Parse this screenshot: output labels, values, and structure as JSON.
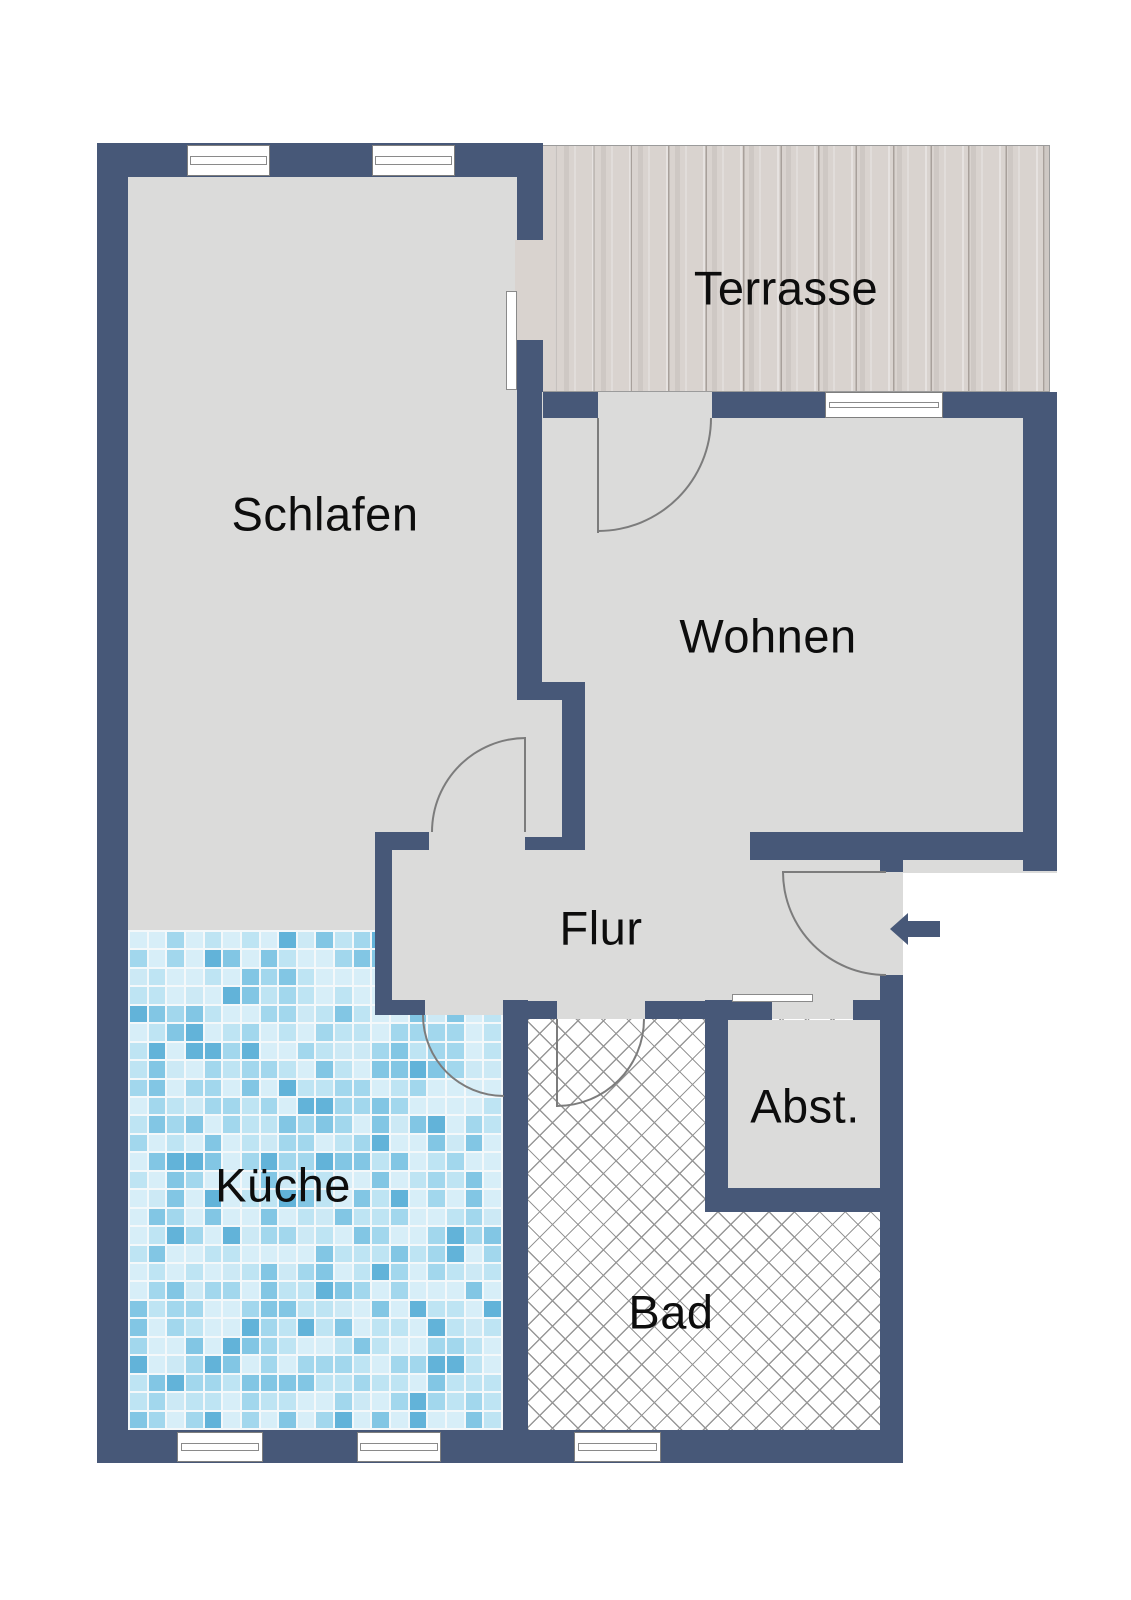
{
  "rooms": [
    {
      "id": "schlafen",
      "label": "Schlafen"
    },
    {
      "id": "terrasse",
      "label": "Terrasse"
    },
    {
      "id": "wohnen",
      "label": "Wohnen"
    },
    {
      "id": "flur",
      "label": "Flur"
    },
    {
      "id": "kueche",
      "label": "Küche"
    },
    {
      "id": "abstellraum",
      "label": "Abst."
    },
    {
      "id": "bad",
      "label": "Bad"
    }
  ],
  "entrance": {
    "arrow_direction": "left"
  },
  "colors": {
    "wall": "#475878",
    "floor": "#dbdbda",
    "terrace_wood": "#d9d3cf",
    "bad_hatch_line": "#979797",
    "window_frame": "#7e7e7e",
    "door_arc": "#7c7c7c",
    "entrance_arrow": "#475878",
    "kitchen_grout": "#f4f8fa",
    "kitchen_tile_palette": [
      "#d7eef8",
      "#bee4f3",
      "#a2d7ed",
      "#82c6e4",
      "#62b3d9",
      "#cce9f5"
    ]
  }
}
